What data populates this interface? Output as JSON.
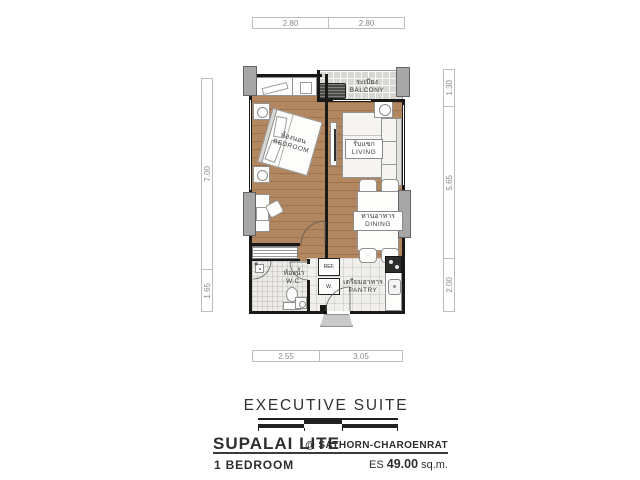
{
  "plan": {
    "dimensions_top": [
      "2.80",
      "2.80"
    ],
    "dimensions_right": [
      "1.30",
      "5.65",
      "2.00"
    ],
    "dimensions_left": [
      "7.00",
      "1.65"
    ],
    "dimensions_bottom": [
      "2.55",
      "3.05"
    ],
    "rooms": {
      "balcony": {
        "th": "ระเบียง",
        "en": "BALCONY"
      },
      "bedroom": {
        "th": "ห้องนอน",
        "en": "BEDROOM"
      },
      "living": {
        "th": "รับแขก",
        "en": "LIVING"
      },
      "dining": {
        "th": "ทานอาหาร",
        "en": "DINING"
      },
      "wc": {
        "th": "ห้องน้ำ",
        "en": "W.C."
      },
      "pantry": {
        "th": "เตรียมอาหาร",
        "en": "PANTRY"
      }
    },
    "appliances": {
      "fridge": "REF.",
      "washer": "W."
    }
  },
  "footer": {
    "suite_title": "EXECUTIVE SUITE",
    "project_name": "SUPALAI LITE",
    "location": "@ SATHORN-CHAROENRAT",
    "unit_type": "1 BEDROOM",
    "area_prefix": "ES",
    "area_value": "49.00",
    "area_unit": "sq.m."
  },
  "colors": {
    "wall": "#1b1918",
    "wood_floor": "#b2875f",
    "balcony_tile": "#d7d7d4",
    "column": "#a7a7a7",
    "text_dark": "#2f2e2c",
    "dim_text": "#8a8a8a"
  }
}
